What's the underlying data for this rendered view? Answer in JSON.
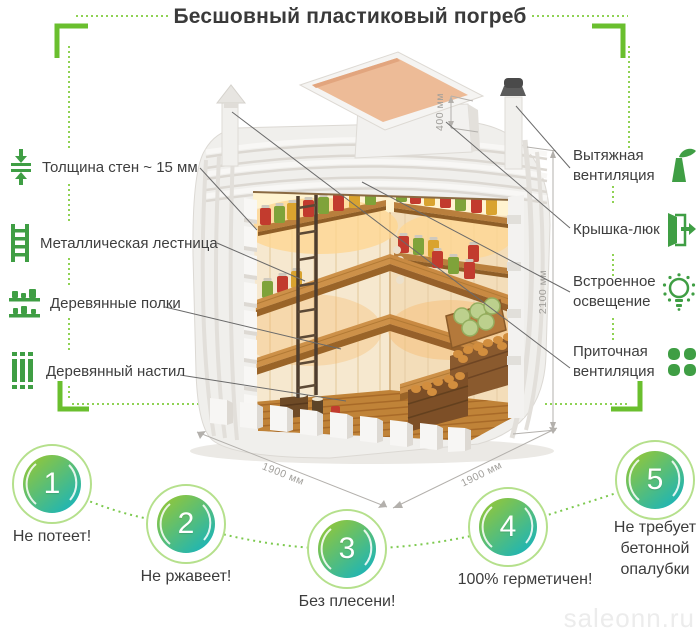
{
  "title": "Бесшовный пластиковый погреб",
  "watermark": "saleonn.ru",
  "colors": {
    "accent_green": "#3f9e44",
    "bracket_green": "#6abf2e",
    "dotted_green": "#8fd254",
    "circle_gradient_start": "#8dc63f",
    "circle_gradient_end": "#1fb5b4",
    "text_dark": "#3d3d3d",
    "dimension_gray": "#9d9b97"
  },
  "left_labels": [
    {
      "icon": "wall-thickness-icon",
      "label": "Толщина стен ~ 15 мм"
    },
    {
      "icon": "ladder-icon",
      "label": "Металлическая лестница"
    },
    {
      "icon": "shelves-icon",
      "label": "Деревянные полки"
    },
    {
      "icon": "floor-planks-icon",
      "label": "Деревянный настил"
    }
  ],
  "right_labels": [
    {
      "icon": "exhaust-vent-icon",
      "line1": "Вытяжная",
      "line2": "вентиляция"
    },
    {
      "icon": "hatch-door-icon",
      "line1": "Крышка-люк",
      "line2": ""
    },
    {
      "icon": "light-bulb-icon",
      "line1": "Встроенное",
      "line2": "освещение"
    },
    {
      "icon": "supply-vent-icon",
      "line1": "Приточная",
      "line2": "вентиляция"
    }
  ],
  "dimensions": {
    "hatch_height": "400 мм",
    "body_height": "2100 мм",
    "base_depth": "1900 мм",
    "base_width": "1900 мм"
  },
  "features": [
    {
      "number": "1",
      "label": "Не потеет!"
    },
    {
      "number": "2",
      "label": "Не ржавеет!"
    },
    {
      "number": "3",
      "label": "Без плесени!"
    },
    {
      "number": "4",
      "label": "100% герметичен!"
    },
    {
      "number": "5",
      "label": "Не требует бетонной опалубки"
    }
  ]
}
